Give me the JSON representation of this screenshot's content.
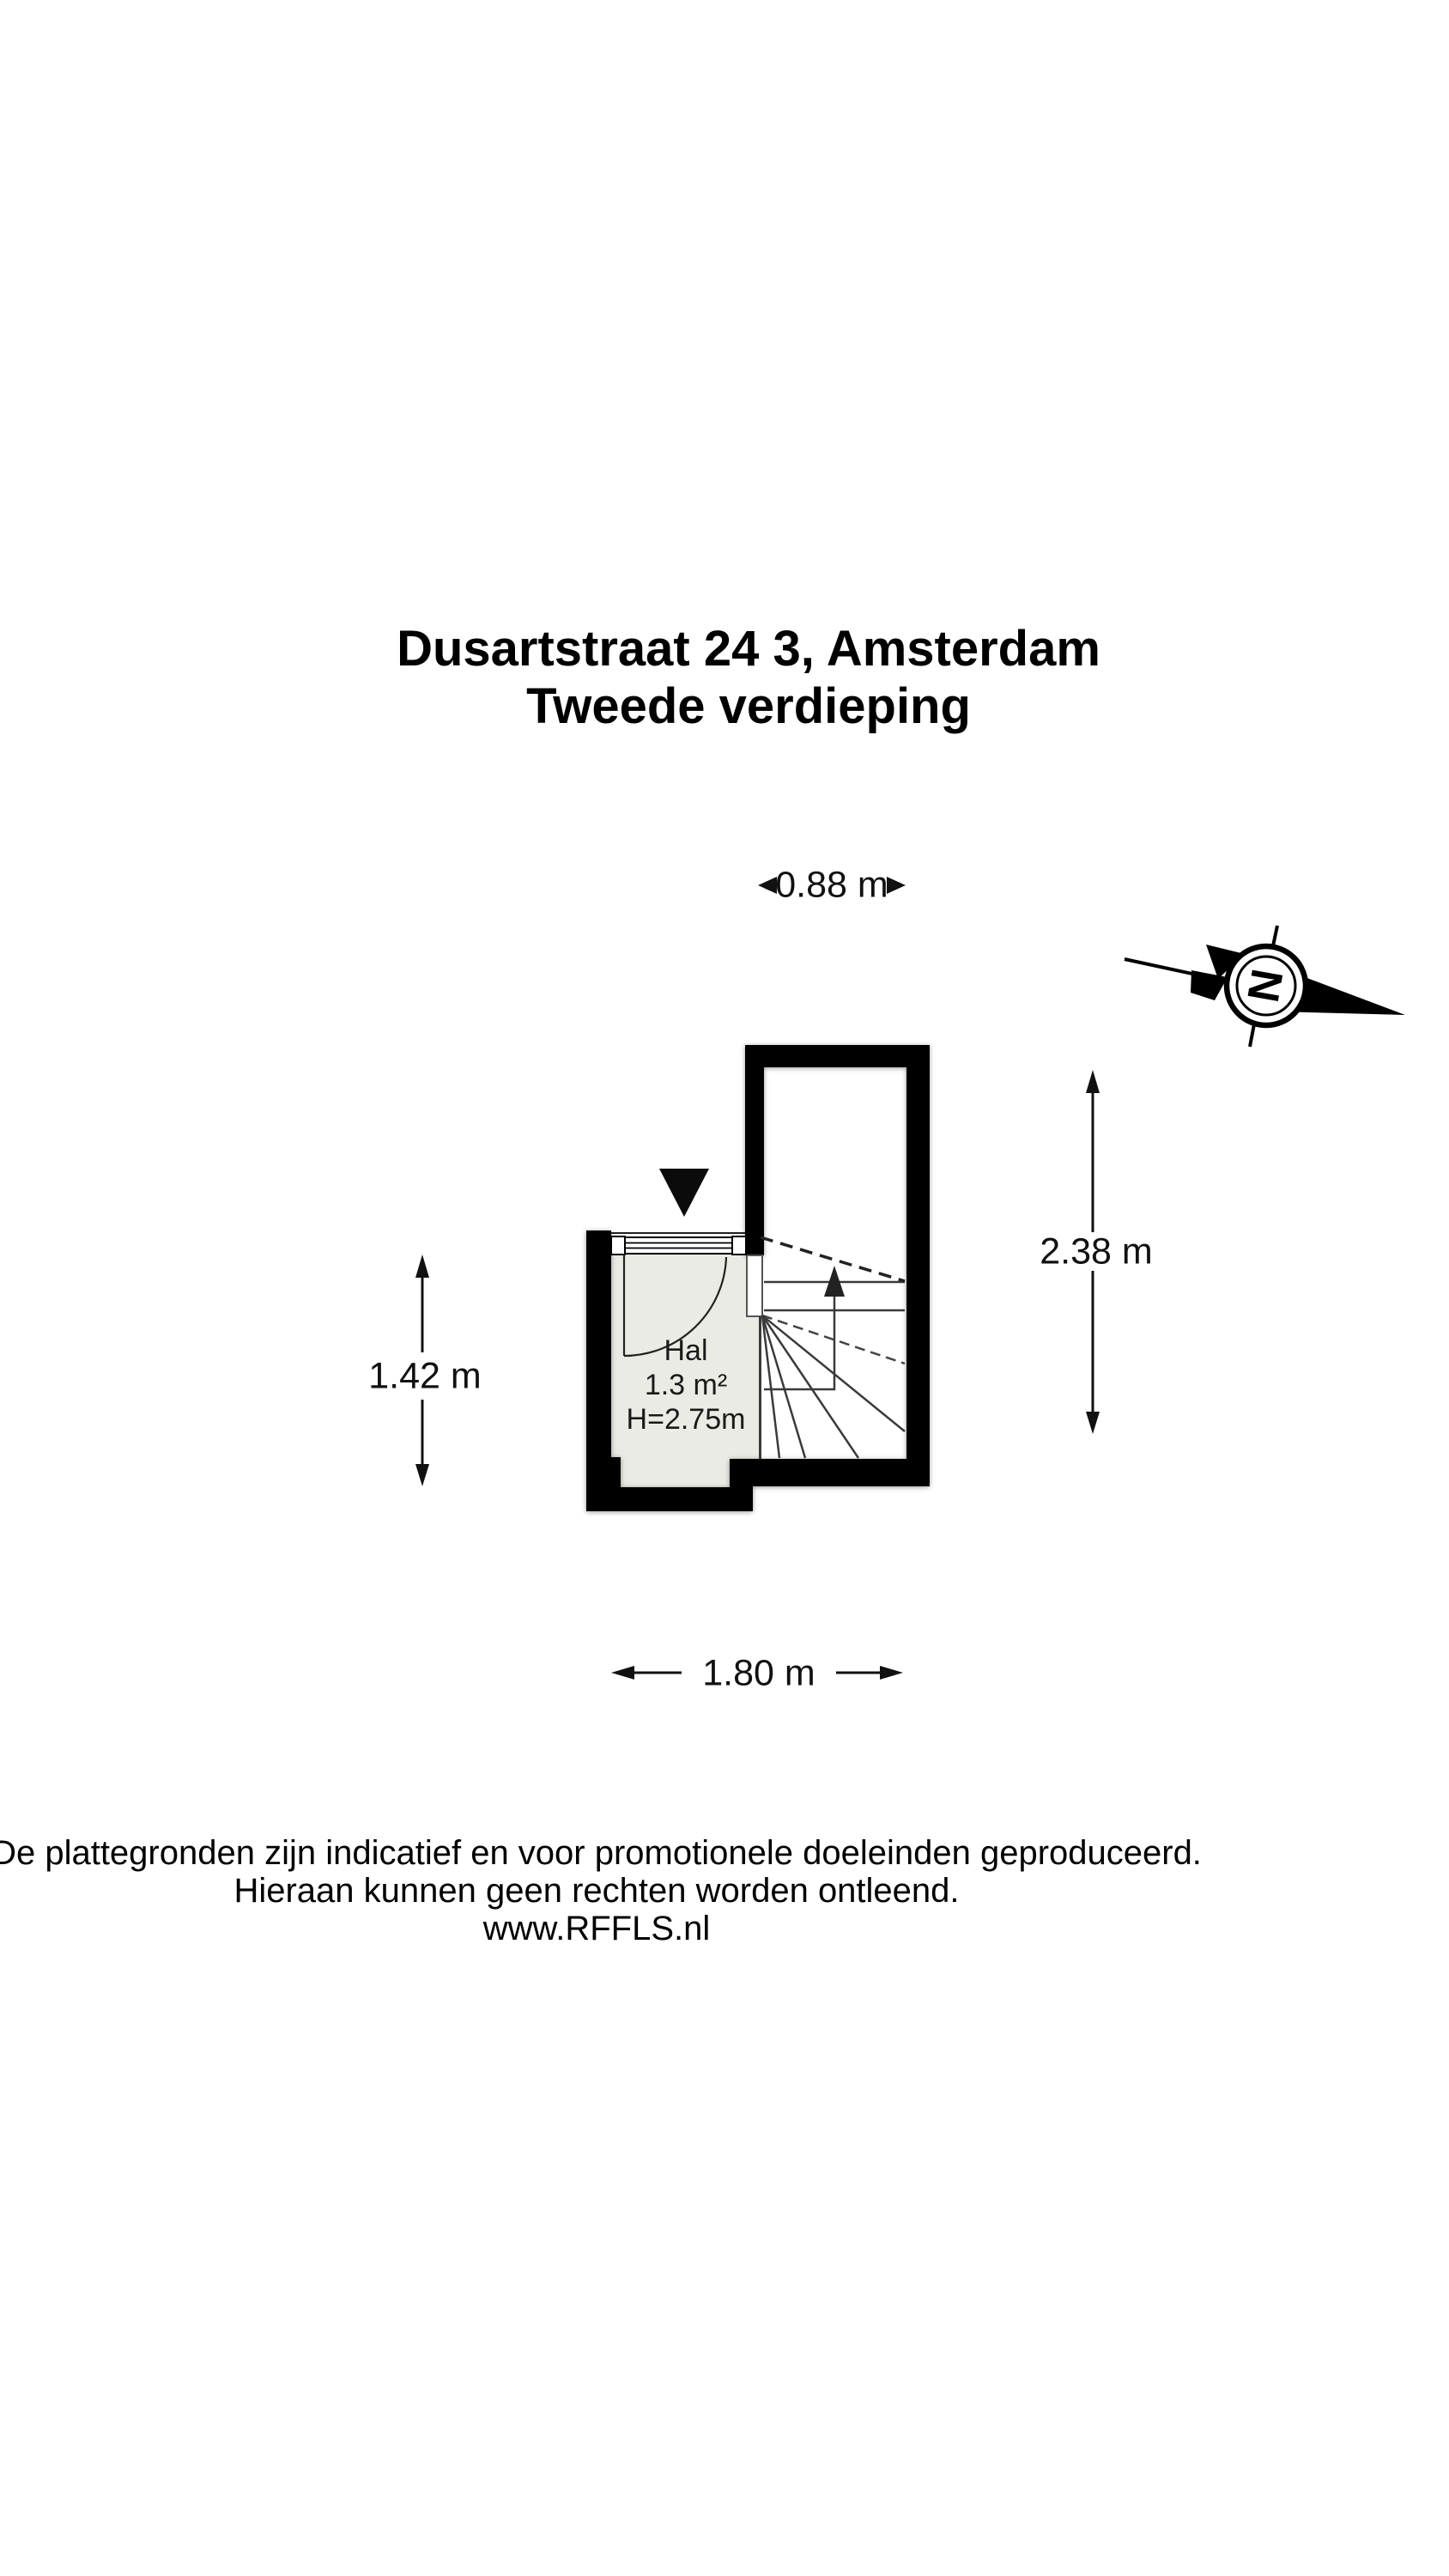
{
  "title": {
    "line1": "Dusartstraat 24 3, Amsterdam",
    "line2": "Tweede verdieping"
  },
  "floorplan": {
    "room": {
      "name": "Hal",
      "area": "1.3 m²",
      "ceiling_height": "H=2.75m"
    },
    "dimensions": {
      "top": "0.88 m",
      "left": "1.42 m",
      "right": "2.38 m",
      "bottom": "1.80 m"
    },
    "compass": {
      "north_letter": "N"
    },
    "colors": {
      "wall": "#000000",
      "hal_floor": "#ebebe5",
      "stair_floor": "#ffffff",
      "stair_line": "#3a3a3a",
      "text": "#111111"
    }
  },
  "footer": {
    "line1": "De plattegronden zijn indicatief en voor promotionele doeleinden geproduceerd.",
    "line2": "Hieraan kunnen geen rechten worden ontleend.",
    "line3": "www.RFFLS.nl"
  }
}
